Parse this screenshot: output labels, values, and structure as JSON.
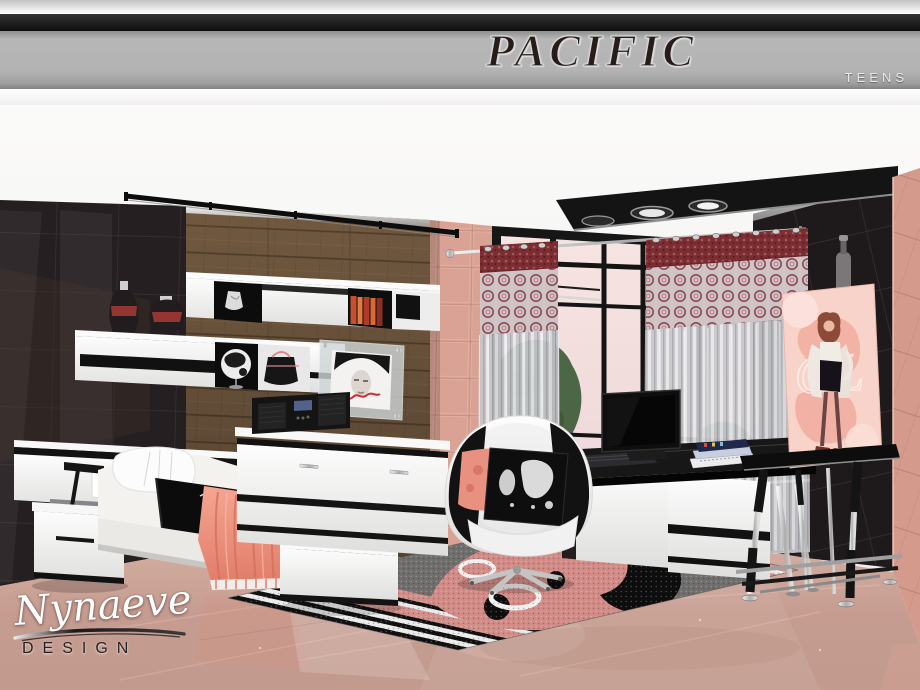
{
  "header": {
    "title": "PACIFIC",
    "tagline": "TEENS"
  },
  "watermark": {
    "name": "Nynaeve",
    "suffix": "DESIGN"
  },
  "easel_poster": {
    "monogram": "GL"
  },
  "colors": {
    "banner_silver": "#b3b3b3",
    "top_bar_black": "#141414",
    "title_text": "#281c18",
    "title_outline": "#d6d6d6",
    "tagline_text": "#e9e9e9",
    "coral_accent": "#e8897a",
    "floor_marble": "#c79e93",
    "pink_tile": "#d9a092",
    "wood_wall": "#715940",
    "dark_glossy_wall": "#241f21",
    "curtain_red": "#7b2d31",
    "rug_pink": "#d28b86",
    "rug_gray": "#6f6e6d",
    "furniture_white": "#f2f2f2",
    "furniture_black": "#121212",
    "chrome": "#c9c9c9",
    "sky_pink": "#f4dedc",
    "foliage_green": "#44633e",
    "watermark_name_color": "#ffffff",
    "watermark_suffix_color": "#242424"
  },
  "scene": {
    "objects": [
      "ceiling-track-light",
      "ceiling-spot-panel",
      "glossy-tile-wall-left",
      "wood-panel-wall",
      "pink-tile-strip",
      "balcony-window",
      "curtain-rod",
      "patterned-curtains",
      "glossy-tile-wall-right",
      "pink-tile-column",
      "wall-shelf-upper",
      "wall-shelf-lower",
      "decor-vases",
      "jewelry-bust",
      "decor-books",
      "globe",
      "handbag",
      "framed-portrait",
      "radio",
      "dresser",
      "headboard-unit",
      "nightstand",
      "desk-lamp",
      "single-bed",
      "pillow",
      "black-blanket",
      "coral-throw",
      "foot-bench",
      "area-rug",
      "swivel-chair",
      "world-map-cushion",
      "coral-cushion",
      "computer-desk",
      "monitor",
      "keyboard",
      "book-stack",
      "display-easel",
      "fashion-poster",
      "marble-floor"
    ]
  }
}
